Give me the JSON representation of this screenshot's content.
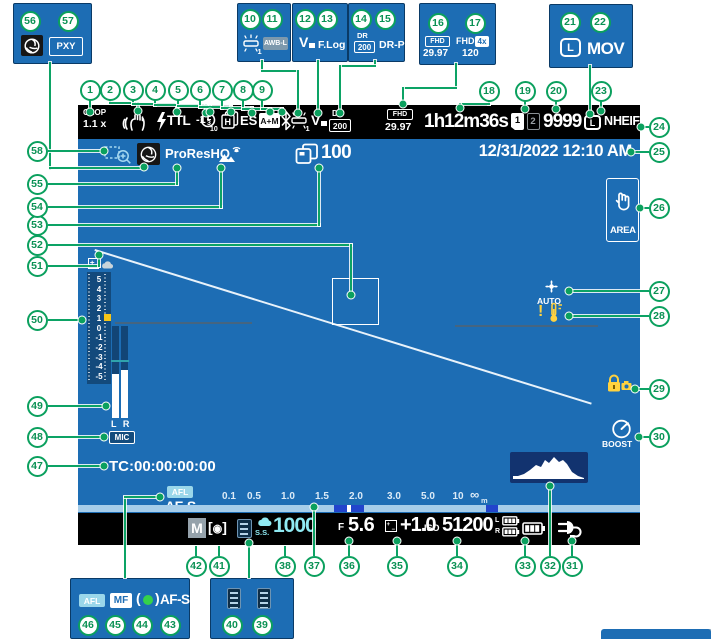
{
  "callouts": [
    "1",
    "2",
    "3",
    "4",
    "5",
    "6",
    "7",
    "8",
    "9",
    "10",
    "11",
    "12",
    "13",
    "14",
    "15",
    "16",
    "17",
    "18",
    "19",
    "20",
    "21",
    "22",
    "23",
    "24",
    "25",
    "26",
    "27",
    "28",
    "29",
    "30",
    "31",
    "32",
    "33",
    "34",
    "35",
    "36",
    "37",
    "38",
    "39",
    "40",
    "41",
    "42",
    "43",
    "44",
    "45",
    "46",
    "47",
    "48",
    "49",
    "50",
    "51",
    "52",
    "53",
    "54",
    "55",
    "56",
    "57",
    "58"
  ],
  "legend": {
    "pxy": "PXY",
    "awb_lock": "AWB-L",
    "flog": "F.Log",
    "drp": "DR-P",
    "fhd4x_label": "FHD",
    "fhd4x_badge": "4x",
    "fhd4x_rate": "120",
    "mov": "MOV",
    "mf": "MF"
  },
  "screen": {
    "top_bar": {
      "crop1": "CROP",
      "crop2": "1.1 x",
      "ttl": "TTL",
      "fc_int": "-1",
      "fc_num": "2",
      "fc_den": "3",
      "timer": "10",
      "burst": "H",
      "es": "ES",
      "am": "A+M",
      "wb1": "1",
      "dr_label": "DR",
      "dr_value": "200",
      "fhd": "FHD",
      "fhd_rate": "29.97",
      "rec_time": "1h12m36s",
      "card1": "1",
      "card2": "2",
      "frames": "9999",
      "size": "L",
      "quality": "N",
      "format": "HEIF"
    },
    "info_row": {
      "codec": "ProResHQ",
      "buffer_count": "100",
      "datetime": "12/31/2022 12:10 AM"
    },
    "left": {
      "exposure_values": [
        "5",
        "4",
        "3",
        "2",
        "1",
        "0",
        "-1",
        "-2",
        "-3",
        "-4",
        "-5"
      ],
      "mic_channels": "L R",
      "mic": "MIC",
      "timecode": "TC:00:00:00:00"
    },
    "af": {
      "afl": "AFL",
      "mode": "AF-S"
    },
    "distance": {
      "labels": [
        "0.1",
        "0.5",
        "1.0",
        "1.5",
        "2.0",
        "3.0",
        "5.0",
        "10"
      ],
      "infinity": "∞",
      "unit": "m"
    },
    "right": {
      "area": "AREA",
      "fan_auto": "AUTO",
      "boost": "BOOST"
    },
    "bottom_bar": {
      "mode": "M",
      "ss_label": "S.S.",
      "ss": "1000",
      "f_label": "F",
      "f": "5.6",
      "ev": "+1.0",
      "iso_label": "ISO",
      "iso": "51200",
      "bat_l": "L",
      "bat_r": "R"
    }
  },
  "colors": {
    "screen_blue": "#1d6db4",
    "callout_green": "#0ba05e",
    "osd_cyan": "#8fe9f2",
    "warning_yellow": "#ffd23f",
    "histogram_navy": "#12336f"
  }
}
